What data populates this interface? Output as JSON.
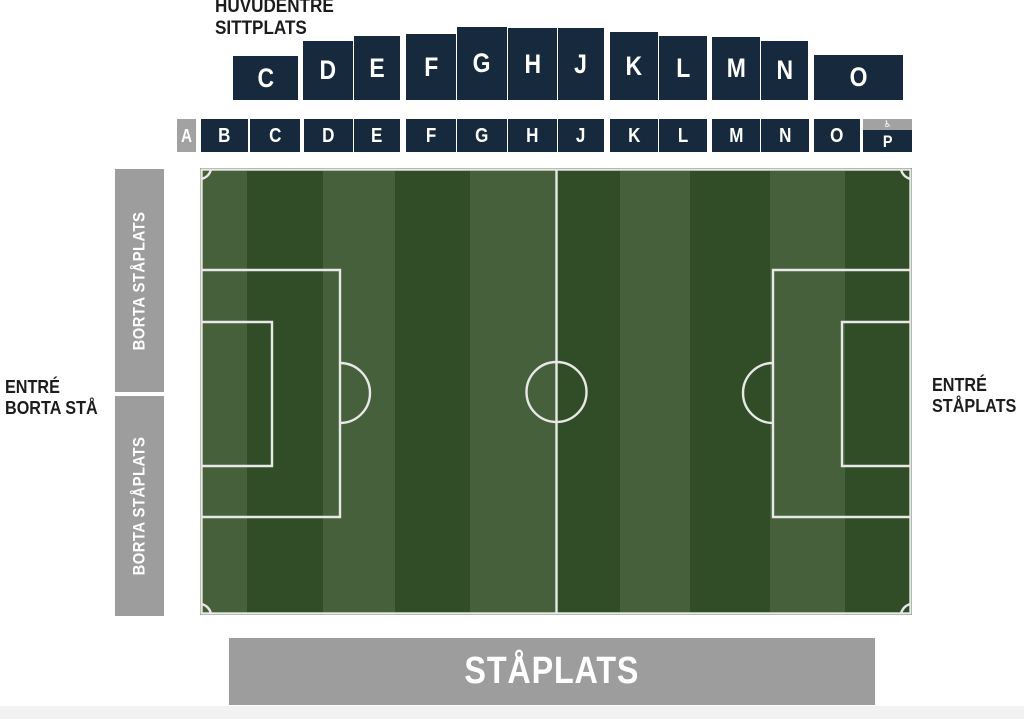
{
  "labels": {
    "main_entrance_line1": "HUVUDENTRÉ",
    "main_entrance_line2": "SITTPLATS",
    "away_entrance_line1": "ENTRÉ",
    "away_entrance_line2": "BORTA STÅ",
    "standing_entrance_line1": "ENTRÉ",
    "standing_entrance_line2": "STÅPLATS",
    "away_stand_upper": "BORTA STÅPLATS",
    "away_stand_lower": "BORTA STÅPLATS",
    "bottom_stand": "STÅPLATS"
  },
  "icons": {
    "wheelchair": "♿"
  },
  "colors": {
    "navy": "#17293c",
    "stand_gray": "#9d9d9d",
    "access_gray": "#a2a2a2",
    "pitch_dark": "#314d27",
    "pitch_light": "#45603a",
    "line_white": "#e8e8e8",
    "page_strip": "#f2f2f3",
    "text_black": "#1c1c1c"
  },
  "upper_tier": {
    "blocks": [
      {
        "label": "C",
        "x": 233,
        "w": 65,
        "t": 56,
        "h": 44
      },
      {
        "label": "D",
        "x": 303,
        "w": 50,
        "t": 41,
        "h": 59
      },
      {
        "label": "E",
        "x": 354,
        "w": 46,
        "t": 36,
        "h": 64
      },
      {
        "label": "F",
        "x": 406,
        "w": 50,
        "t": 34,
        "h": 66
      },
      {
        "label": "G",
        "x": 457,
        "w": 50,
        "t": 27,
        "h": 73
      },
      {
        "label": "H",
        "x": 508,
        "w": 49,
        "t": 28,
        "h": 72
      },
      {
        "label": "J",
        "x": 558,
        "w": 46,
        "t": 28,
        "h": 72
      },
      {
        "label": "K",
        "x": 610,
        "w": 48,
        "t": 32,
        "h": 68
      },
      {
        "label": "L",
        "x": 659,
        "w": 48,
        "t": 36,
        "h": 64
      },
      {
        "label": "M",
        "x": 712,
        "w": 48,
        "t": 37,
        "h": 63
      },
      {
        "label": "N",
        "x": 761,
        "w": 47,
        "t": 41,
        "h": 59
      },
      {
        "label": "O",
        "x": 814,
        "w": 89,
        "t": 55,
        "h": 45
      }
    ]
  },
  "lower_tier": {
    "blocks": [
      {
        "label": "A",
        "x": 177,
        "w": 19,
        "variant": "gray"
      },
      {
        "label": "B",
        "x": 201,
        "w": 47
      },
      {
        "label": "C",
        "x": 250,
        "w": 50
      },
      {
        "label": "D",
        "x": 304,
        "w": 49
      },
      {
        "label": "E",
        "x": 354,
        "w": 46
      },
      {
        "label": "F",
        "x": 406,
        "w": 50
      },
      {
        "label": "G",
        "x": 457,
        "w": 50
      },
      {
        "label": "H",
        "x": 508,
        "w": 49
      },
      {
        "label": "J",
        "x": 558,
        "w": 46
      },
      {
        "label": "K",
        "x": 610,
        "w": 48
      },
      {
        "label": "L",
        "x": 659,
        "w": 48
      },
      {
        "label": "M",
        "x": 712,
        "w": 48
      },
      {
        "label": "N",
        "x": 761,
        "w": 48
      },
      {
        "label": "O",
        "x": 814,
        "w": 46
      },
      {
        "label": "P",
        "x": 863,
        "w": 49,
        "variant": "accessible"
      }
    ]
  }
}
